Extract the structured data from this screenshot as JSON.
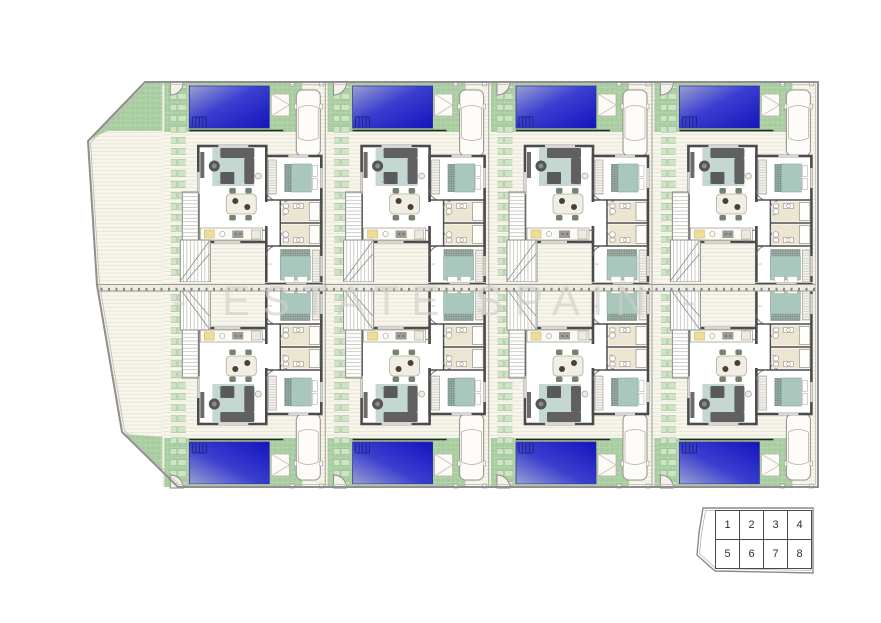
{
  "watermark": {
    "text": "- ESTATE SPAIN -"
  },
  "key_plan": {
    "cells": [
      "1",
      "2",
      "3",
      "4",
      "5",
      "6",
      "7",
      "8"
    ]
  },
  "plan": {
    "unit_count": 8,
    "unit_ids": [
      "1",
      "2",
      "3",
      "4",
      "5",
      "6",
      "7",
      "8"
    ],
    "area_label": "m²"
  },
  "colors": {
    "pool_blue": "#2d2fc9",
    "grass_green": "#a7cc9f",
    "path_green": "#cfe3c7",
    "wall_dark": "#4b4b4b",
    "terrace_beige": "#f7f5ec",
    "bed_teal": "#a9c7bc",
    "watermark_gray": "#cfcfc9"
  }
}
